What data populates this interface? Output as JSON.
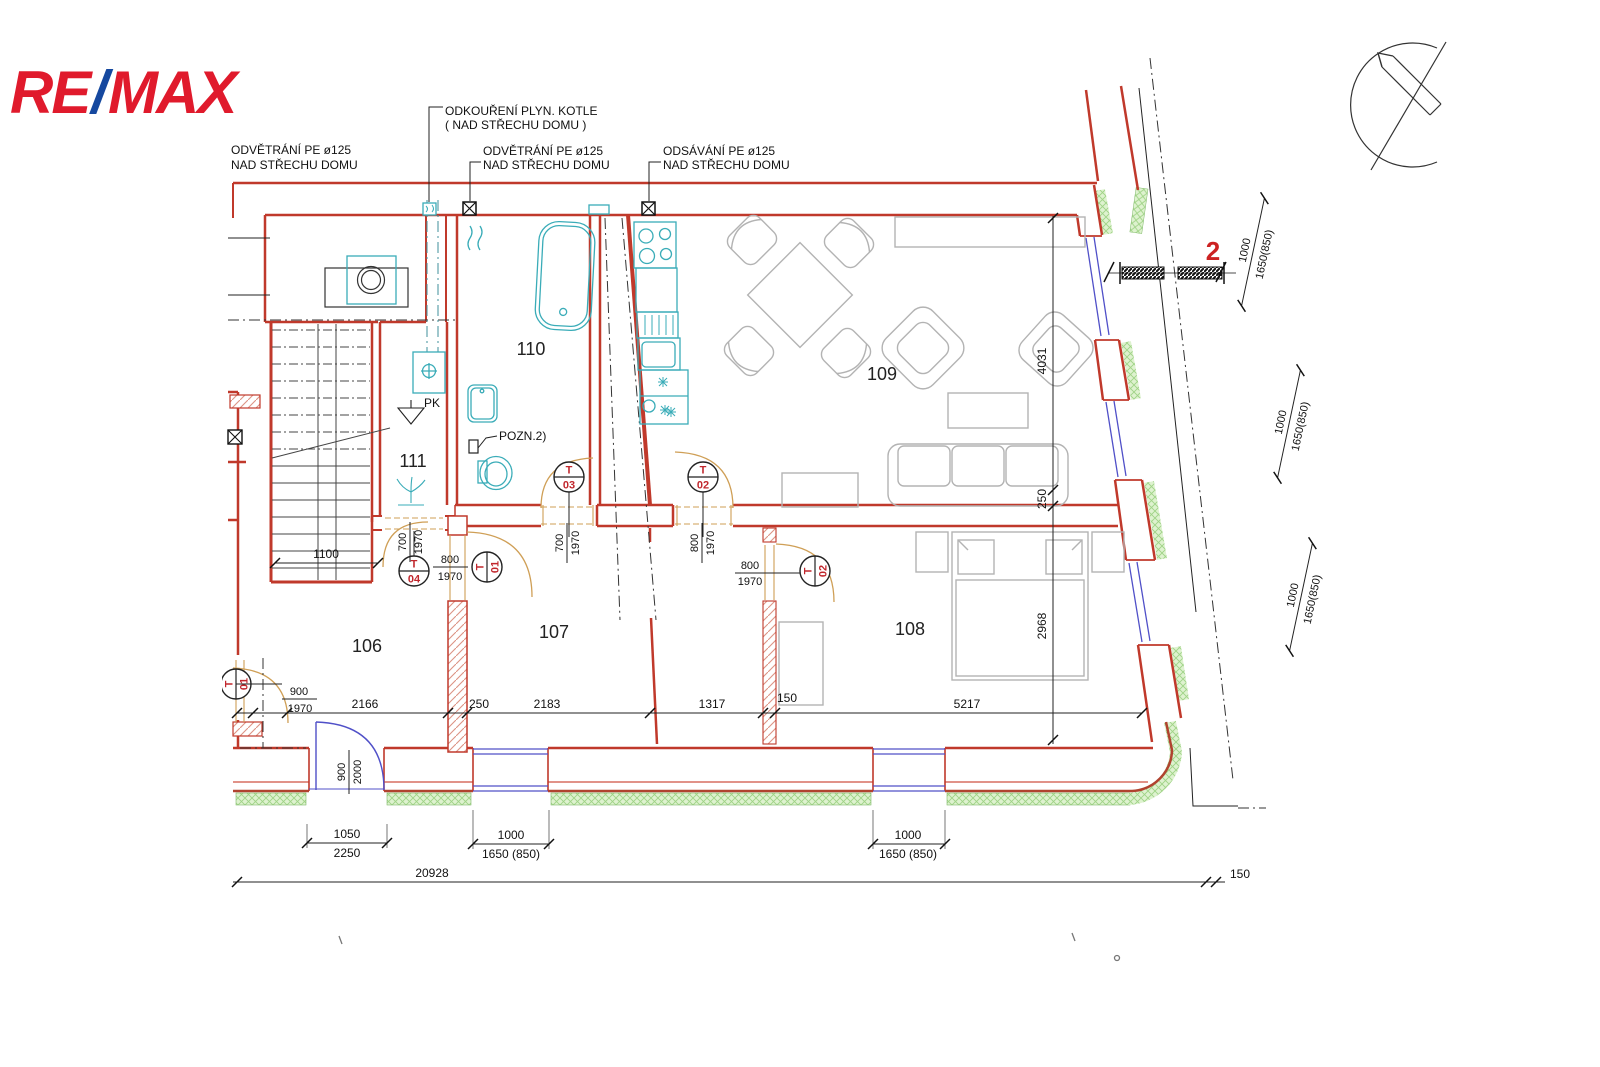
{
  "brand": {
    "re": "RE",
    "slash": "/",
    "max": "MAX"
  },
  "section": {
    "label": "2"
  },
  "labels": {
    "pk": "PK",
    "note": "POZN.2)"
  },
  "annotations": {
    "left1": "ODVĚTRÁNÍ PE ø125",
    "left2": "NAD STŘECHU DOMU",
    "boiler1": "ODKOUŘENÍ PLYN. KOTLE",
    "boiler2": "( NAD STŘECHU DOMU )",
    "vent1": "ODVĚTRÁNÍ PE ø125",
    "vent2": "NAD STŘECHU DOMU",
    "exhaust1": "ODSÁVÁNÍ PE ø125",
    "exhaust2": "NAD STŘECHU DOMU"
  },
  "rooms": {
    "r106": "106",
    "r107": "107",
    "r108": "108",
    "r109": "109",
    "r110": "110",
    "r111": "111"
  },
  "doors": {
    "t": "T",
    "n01": "01",
    "n02": "02",
    "n03": "03",
    "n04": "04"
  },
  "dims": {
    "d700": "700",
    "d800": "800",
    "d900": "900",
    "d1000": "1000",
    "d1050": "1050",
    "d1100": "1100",
    "d150": "150",
    "d1317": "1317",
    "d1650": "1650 (850)",
    "d1650c": "1650(850)",
    "d1970": "1970",
    "d2000": "2000",
    "d20928": "20928",
    "d2166": "2166",
    "d2183": "2183",
    "d2250": "2250",
    "d250": "250",
    "d2968": "2968",
    "d4031": "4031",
    "d5217": "5217"
  }
}
